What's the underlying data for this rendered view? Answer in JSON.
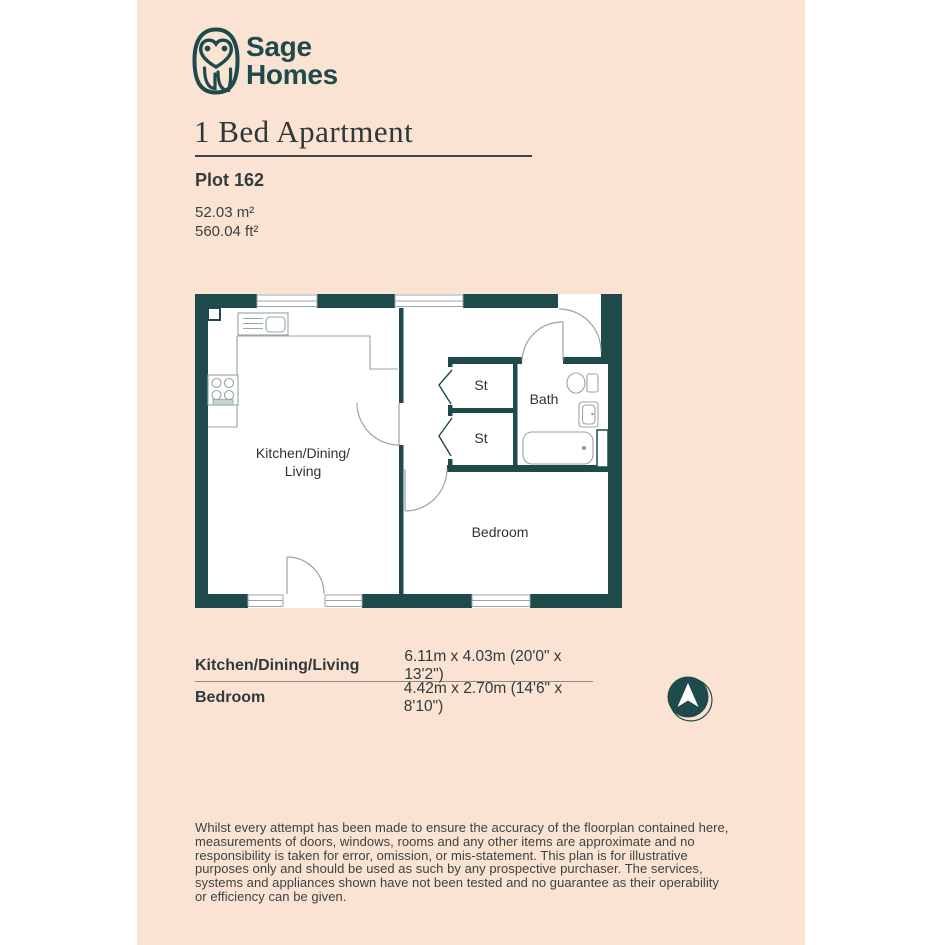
{
  "brand": {
    "name_line1": "Sage",
    "name_line2": "Homes"
  },
  "header": {
    "title": "1 Bed Apartment",
    "plot": "Plot 162",
    "area_sqm": "52.03 m²",
    "area_sqft": "560.04 ft²"
  },
  "plan": {
    "rooms": {
      "kitchen_line1": "Kitchen/Dining/",
      "kitchen_line2": "Living",
      "bedroom": "Bedroom",
      "bath": "Bath",
      "storage1": "St",
      "storage2": "St"
    }
  },
  "dimensions_table": {
    "rows": [
      {
        "room": "Kitchen/Dining/Living",
        "size": "6.11m x 4.03m (20'0\" x 13'2\")"
      },
      {
        "room": "Bedroom",
        "size": "4.42m x 2.70m (14'6\" x 8'10\")"
      }
    ]
  },
  "compass": {
    "direction": "north"
  },
  "disclaimer": "Whilst every attempt has been made to ensure the accuracy of the floorplan contained here, measurements of doors, windows, rooms and any other items are approximate and no responsibility is taken for error, omission, or mis-statement. This plan is for illustrative purposes only and should be used as such by any prospective purchaser. The services, systems and appliances shown have not been tested and no guarantee as their operability or efficiency can be given.",
  "colors": {
    "teal": "#1e4a4c",
    "peach": "#fbe3d3",
    "text": "#3a4143"
  }
}
